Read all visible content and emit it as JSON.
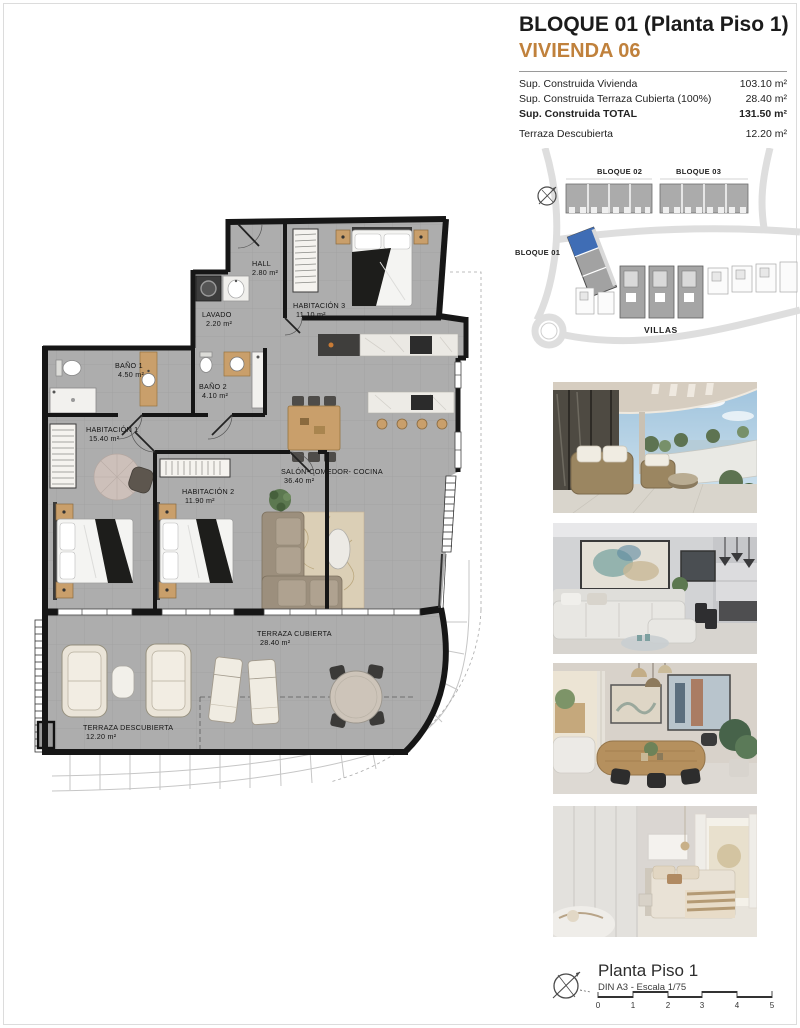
{
  "header": {
    "title": "BLOQUE 01  (Planta Piso 1)",
    "subtitle": "VIVIENDA 06",
    "rows": [
      {
        "label": "Sup. Construida Vivienda",
        "value": "103.10 m²"
      },
      {
        "label": "Sup. Construida Terraza Cubierta (100%)",
        "value": "28.40 m²"
      },
      {
        "label": "Sup. Construida TOTAL",
        "value": "131.50 m²"
      },
      {
        "label": "Terraza Descubierta",
        "value": "12.20 m²"
      }
    ]
  },
  "site_plan": {
    "bloque01": "BLOQUE 01",
    "bloque02": "BLOQUE 02",
    "bloque03": "BLOQUE 03",
    "villas": "VILLAS"
  },
  "floor_plan": {
    "rooms": [
      {
        "name": "HALL",
        "area": "2.80 m²"
      },
      {
        "name": "LAVADO",
        "area": "2.20 m²"
      },
      {
        "name": "HABITACIÓN 3",
        "area": "11.10 m²"
      },
      {
        "name": "BAÑO 1",
        "area": "4.50 m²"
      },
      {
        "name": "BAÑO 2",
        "area": "4.10 m²"
      },
      {
        "name": "HABITACIÓN 1",
        "area": "15.40 m²"
      },
      {
        "name": "HABITACIÓN 2",
        "area": "11.90 m²"
      },
      {
        "name": "SALÓN-COMEDOR- COCINA",
        "area": "36.40 m²"
      },
      {
        "name": "TERRAZA CUBIERTA",
        "area": "28.40 m²"
      },
      {
        "name": "TERRAZA DESCUBIERTA",
        "area": "12.20 m²"
      }
    ]
  },
  "footer": {
    "title": "Planta Piso 1",
    "scale_note": "DIN A3 - Escala 1/75",
    "scale_ticks": [
      "0",
      "1",
      "2",
      "3",
      "4",
      "5"
    ]
  },
  "colors": {
    "accent": "#c0813c",
    "highlight_blue": "#3f6db5"
  }
}
